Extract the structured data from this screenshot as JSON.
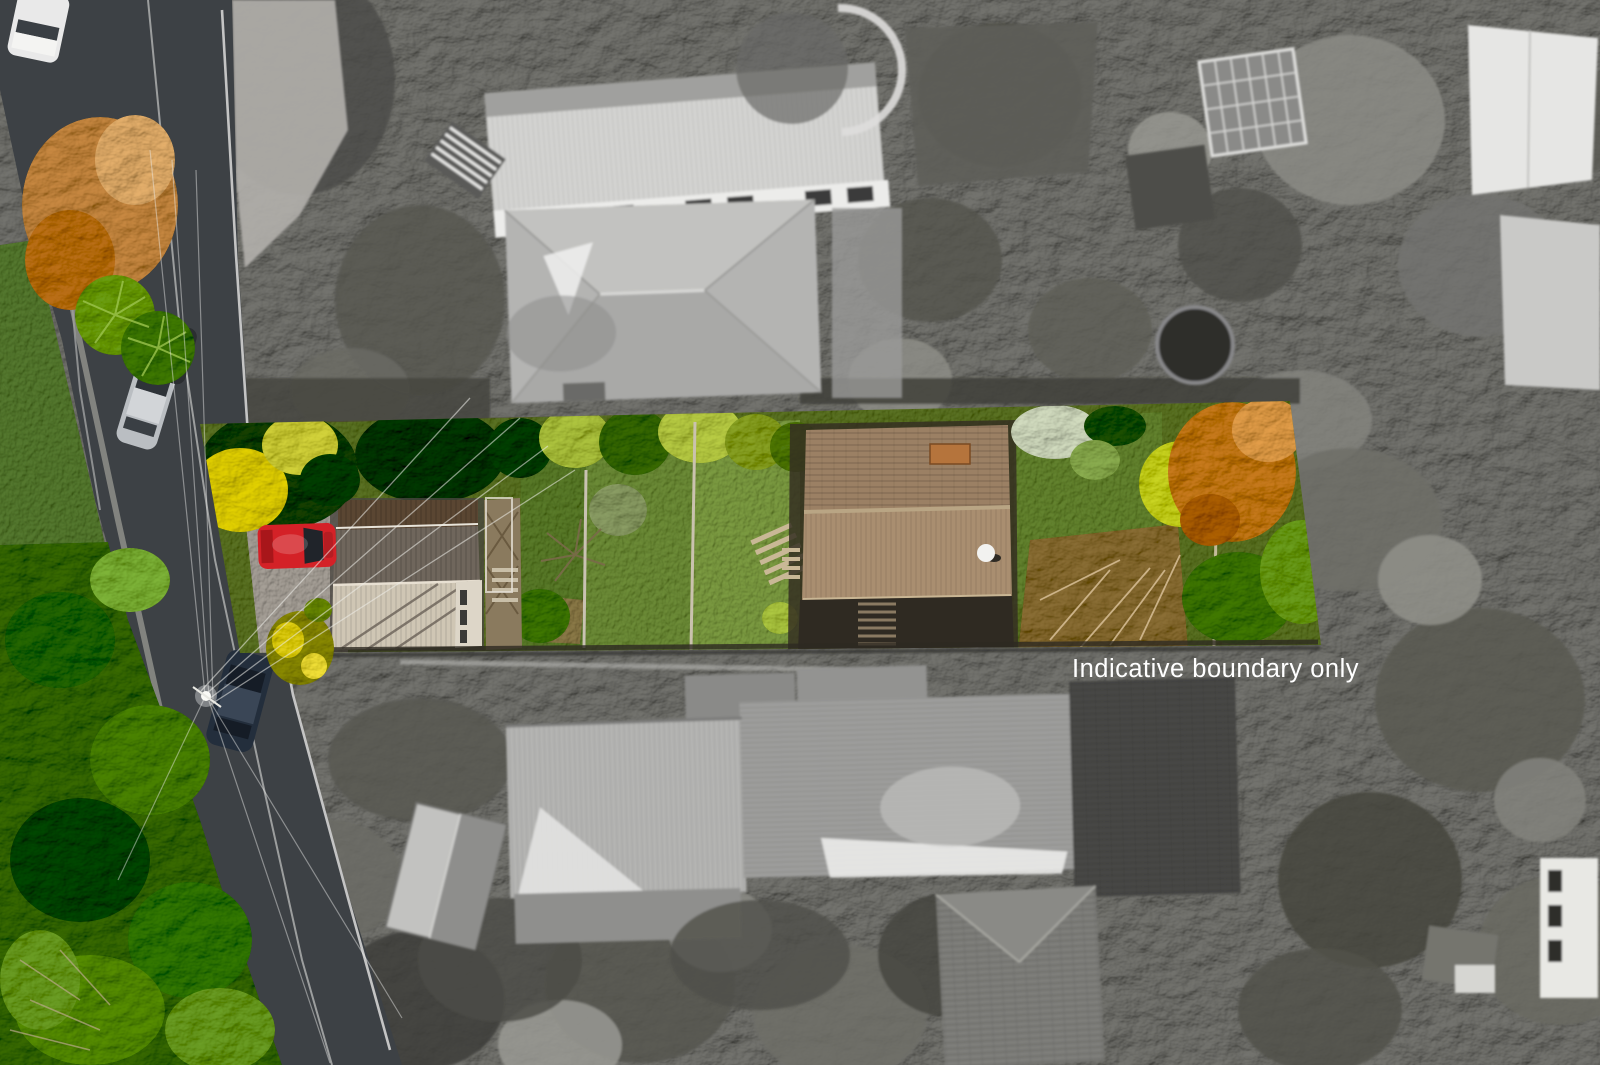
{
  "watermark": {
    "text": "Indicative boundary only",
    "color": "#ffffff"
  },
  "scene": {
    "kind": "aerial drone photo of a residential property",
    "highlight": "long east-west section shown in colour, surroundings desaturated",
    "visible_objects": [
      "street running diagonally down the left side",
      "white car driving on road top left",
      "silver car driving on road",
      "dark car parked under cabbage trees",
      "red car parked at property frontage",
      "navy car parked further down the road",
      "power pole with radiating wires",
      "front dwelling with grey corrugated gable roof",
      "rear dwelling with brown tiled hip roof and satellite dish",
      "lawns divided by timber fences",
      "autumn orange tree at rear boundary",
      "kowhai tree with yellow flowers at street frontage",
      "native bush reserve along lower left",
      "grey neighbouring houses above and below the property"
    ]
  },
  "colors": {
    "grayscale_base": "#767672",
    "road_asphalt": "#3d4145",
    "red_car": "#d42127",
    "navy_car": "#232e3c",
    "silver_car": "#babec2",
    "white_car": "#e9e9e9",
    "highlight_lawn": "#5f7434",
    "front_roof_light": "#cfc6b4",
    "front_roof_dark": "#6f665c",
    "rear_roof_upper": "#9b8064",
    "rear_roof_lower": "#a98e70",
    "autumn_tree": "#c07c3c",
    "kowhai_yellow": "#d8c832",
    "bush_green": "#4a6e2e"
  }
}
